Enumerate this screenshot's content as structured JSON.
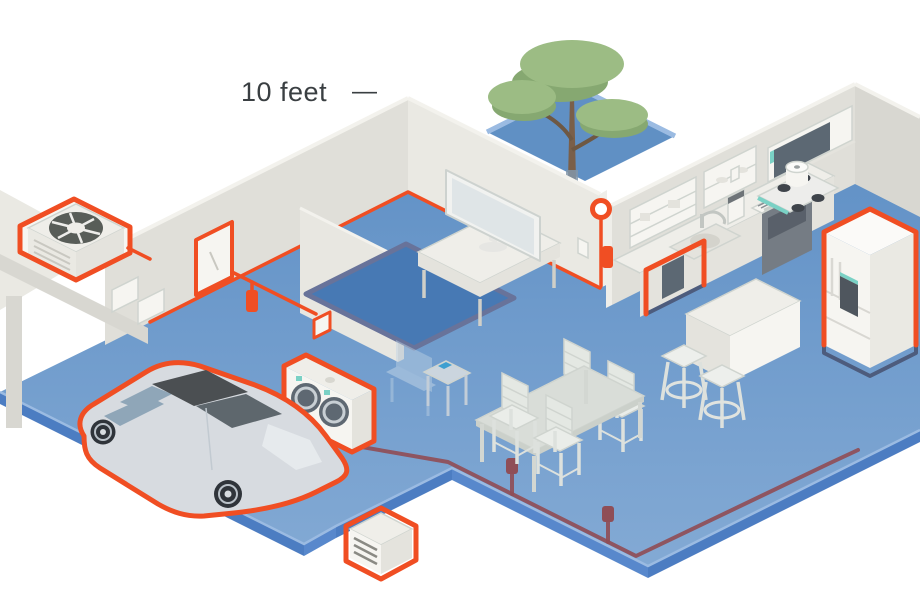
{
  "label": {
    "text": "10 feet",
    "dash": "—"
  },
  "palette": {
    "orange": "#F04E23",
    "navy": "#4D5C7D",
    "maroon": "#8F4E57",
    "floorEdge": "#4C7DC2",
    "floorEdgeLight": "#5888CC",
    "floorRim": "#9BBBE2",
    "courtyard": "#6090C4",
    "rug": "#4779B4",
    "rugBorder": "#68739A",
    "wall": "#E0DFD9",
    "wallLight": "#EAE9E3",
    "wallTop": "#F3F2ED",
    "wallShade": "#D8D7D1",
    "partition": "#E8E7E1",
    "white": "#F6F5F1",
    "white2": "#EFEEE9",
    "shade": "#E4E3DD",
    "frame": "#D5D4CE",
    "glass": "#8FA6B8",
    "glassDark": "#5E676D",
    "carBody": "#D7DBE0",
    "carShade": "#C2CAD1",
    "carDark": "#4B4F52",
    "wheel": "#2F343A",
    "teal": "#7AD1C5",
    "screen": "#5C6873",
    "applianceDark": "#3F444B",
    "ovenFace": "#757C84",
    "treeLight": "#9CBC84",
    "treeDark": "#86A871",
    "trunk": "#7A5F49",
    "fan": "#585D58",
    "chair": "#E4E8E3",
    "chairLine": "#CFD4CF",
    "furn": "#D9DDD8",
    "text": "#3A3F42"
  },
  "scene": {
    "items": [
      "hvac-unit",
      "breaker-panel",
      "ev-charger-plug",
      "ev-car",
      "washer-dryer",
      "dishwasher",
      "refrigerator",
      "wall-sensor",
      "utility-cabinet",
      "tree",
      "tv",
      "dining-table",
      "kitchen-island"
    ]
  }
}
